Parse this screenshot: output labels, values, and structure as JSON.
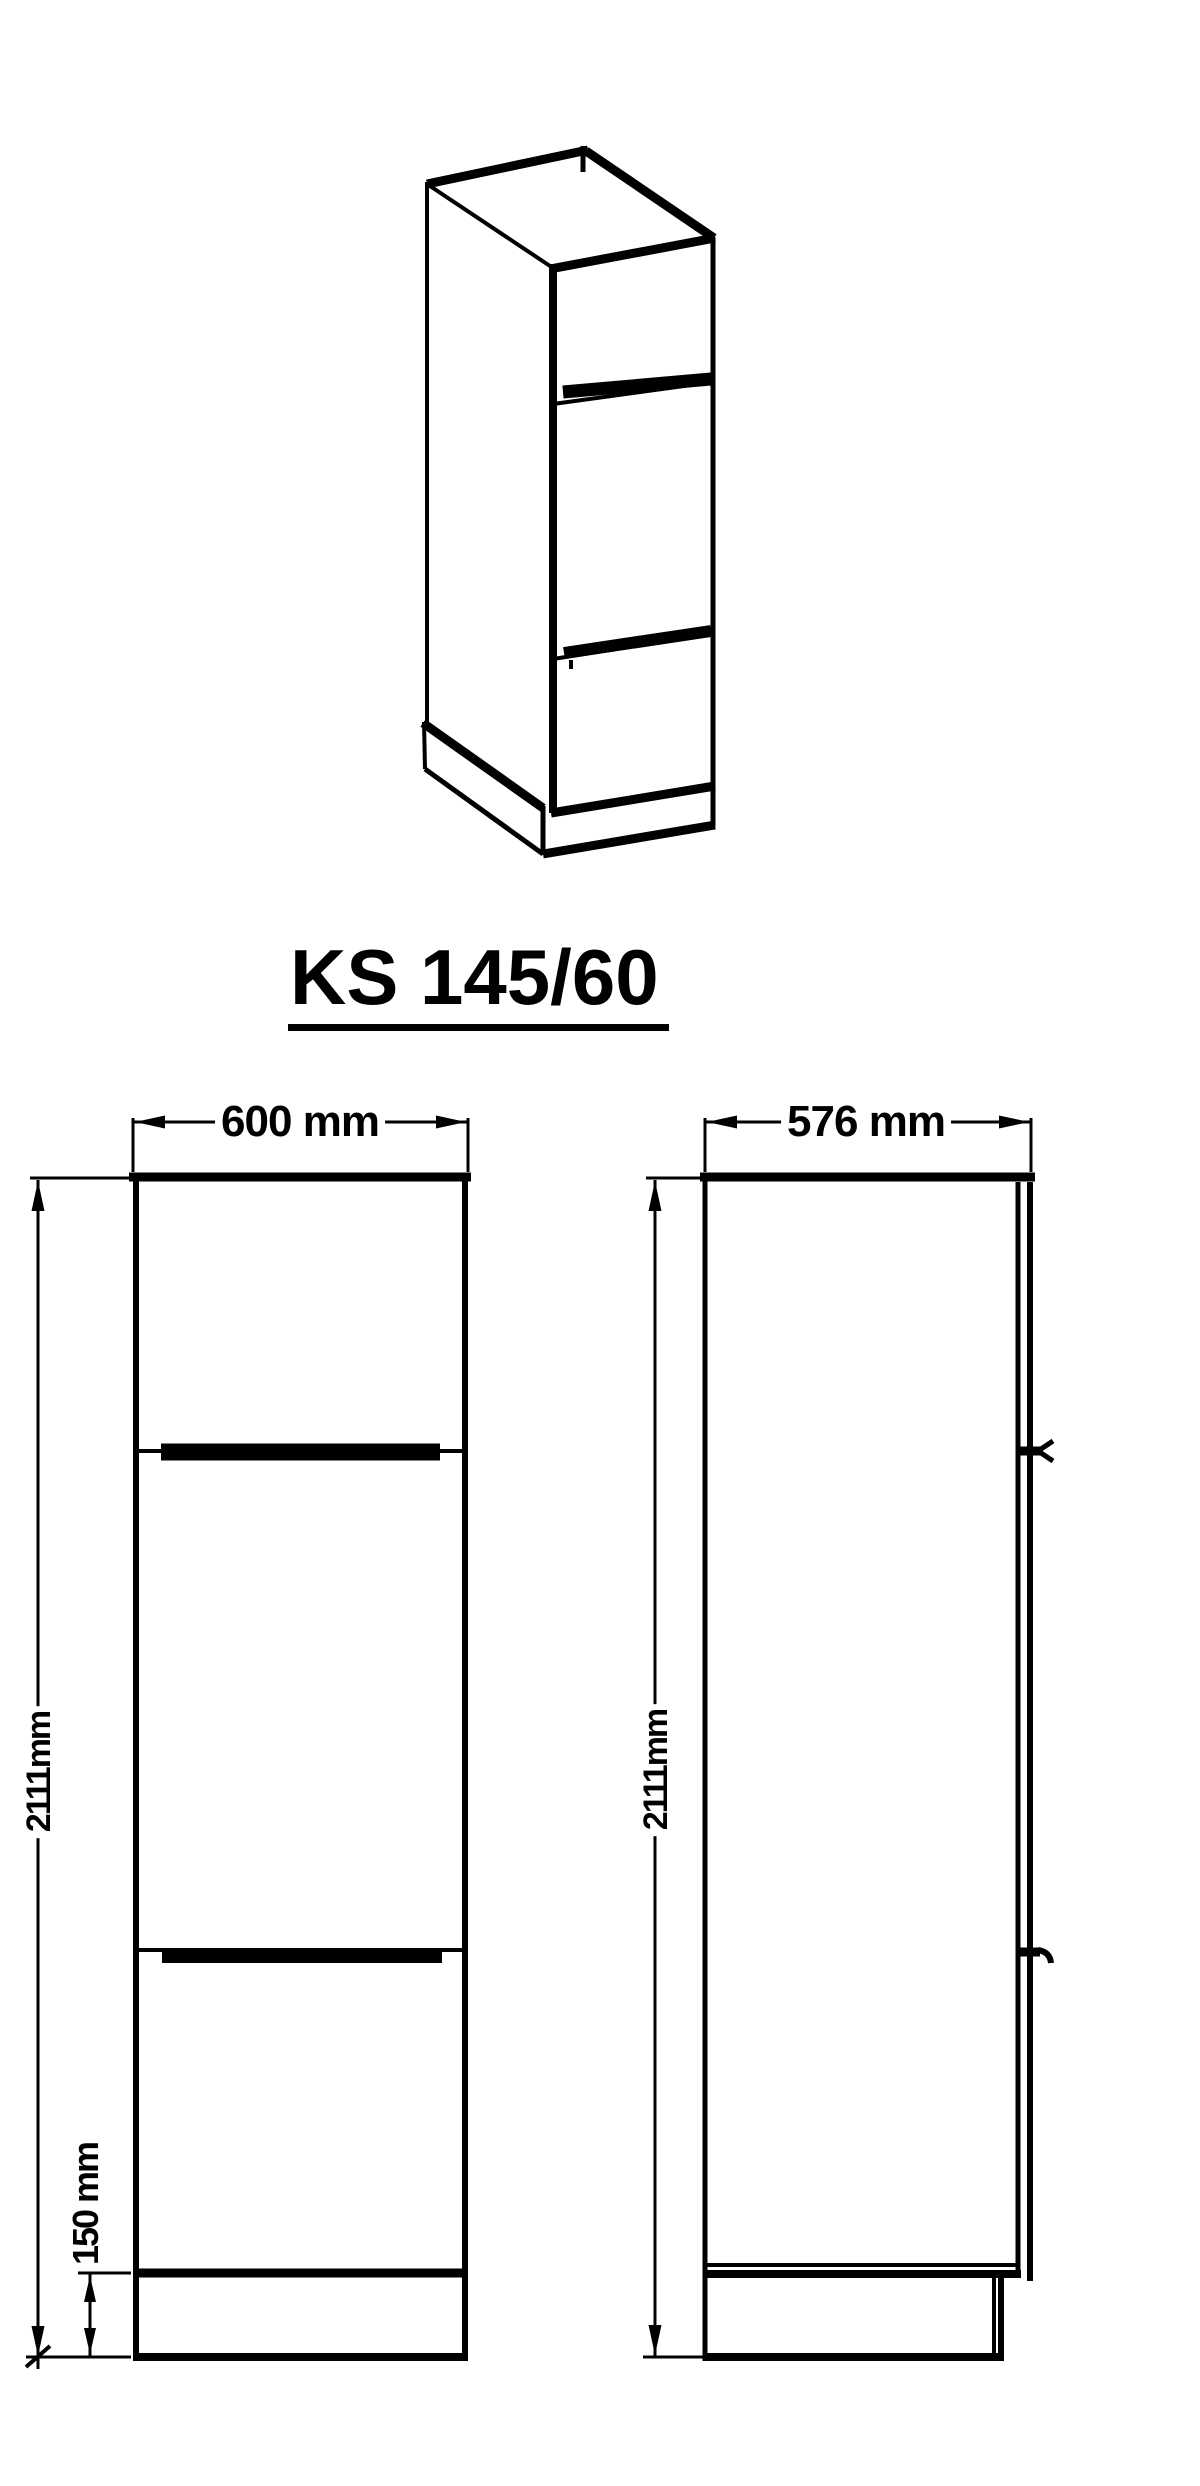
{
  "colors": {
    "ink": "#000000",
    "background": "#ffffff"
  },
  "title": {
    "text": "KS 145/60"
  },
  "front_view": {
    "width_label": "600 mm",
    "height_label": "2111mm",
    "plinth_label": "150 mm"
  },
  "side_view": {
    "depth_label": "576 mm",
    "height_label": "2111mm"
  },
  "dimensions_mm": {
    "width": 600,
    "depth": 576,
    "height": 2111,
    "plinth_height": 150
  }
}
